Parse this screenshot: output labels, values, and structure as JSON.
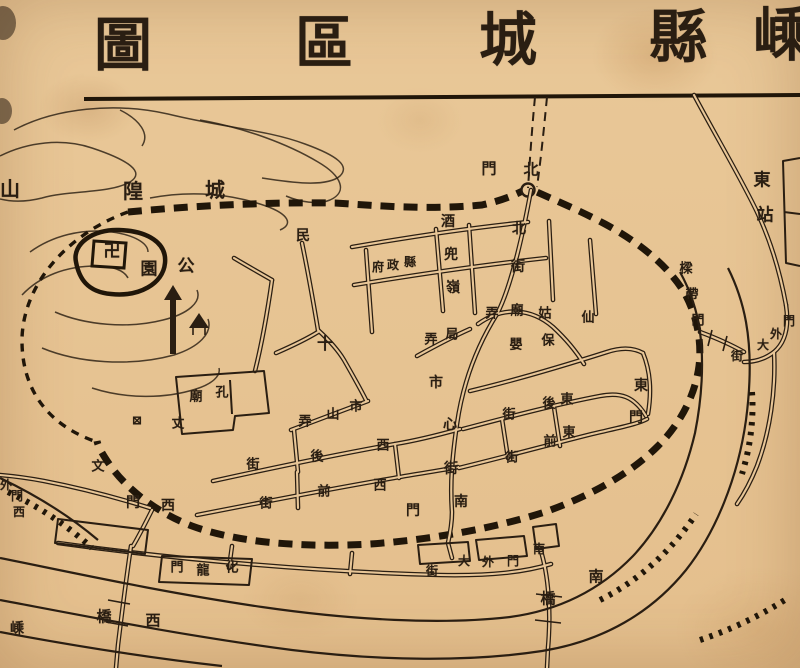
{
  "colors": {
    "paper": "#e8c697",
    "ink": "#2a1e12",
    "wall": "#201609"
  },
  "title": {
    "text": "嵊縣城區圖",
    "reading": "right-to-left",
    "size": 58,
    "chars": [
      {
        "c": "圖",
        "x": 123,
        "y": 45
      },
      {
        "c": "區",
        "x": 324,
        "y": 43
      },
      {
        "c": "城",
        "x": 508,
        "y": 40
      },
      {
        "c": "縣",
        "x": 678,
        "y": 37
      },
      {
        "c": "嵊",
        "x": 782,
        "y": 35
      }
    ]
  },
  "map": {
    "labels": [
      {
        "name": "chenghuang-hill",
        "text": "城隍山",
        "size": 20,
        "chars": [
          {
            "c": "城",
            "x": 215,
            "y": 190
          },
          {
            "c": "隍",
            "x": 133,
            "y": 191
          },
          {
            "c": "山",
            "x": 10,
            "y": 189
          }
        ]
      },
      {
        "name": "park",
        "text": "公園",
        "size": 17,
        "chars": [
          {
            "c": "公",
            "x": 186,
            "y": 267
          },
          {
            "c": "園",
            "x": 149,
            "y": 270
          }
        ]
      },
      {
        "name": "min-label",
        "text": "民",
        "size": 14,
        "chars": [
          {
            "c": "民",
            "x": 303,
            "y": 236
          }
        ]
      },
      {
        "name": "north-gate",
        "text": "北門",
        "size": 15,
        "chars": [
          {
            "c": "北",
            "x": 531,
            "y": 170
          },
          {
            "c": "門",
            "x": 489,
            "y": 169
          }
        ]
      },
      {
        "name": "east-station",
        "text": "東站",
        "size": 17,
        "chars": [
          {
            "c": "東",
            "x": 762,
            "y": 181
          },
          {
            "c": "站",
            "x": 765,
            "y": 216
          }
        ]
      },
      {
        "name": "jiudou-ridge",
        "text": "酒兜嶺",
        "size": 14,
        "chars": [
          {
            "c": "酒",
            "x": 448,
            "y": 222
          },
          {
            "c": "兜",
            "x": 451,
            "y": 255
          },
          {
            "c": "嶺",
            "x": 453,
            "y": 288
          }
        ]
      },
      {
        "name": "north-street",
        "text": "北街",
        "size": 14,
        "chars": [
          {
            "c": "北",
            "x": 519,
            "y": 229
          },
          {
            "c": "街",
            "x": 518,
            "y": 267
          }
        ]
      },
      {
        "name": "county-government",
        "text": "縣政府",
        "size": 12,
        "chars": [
          {
            "c": "府",
            "x": 378,
            "y": 267
          },
          {
            "c": "政",
            "x": 393,
            "y": 265
          },
          {
            "c": "縣",
            "x": 410,
            "y": 262
          }
        ]
      },
      {
        "name": "xiangu-temple-lane",
        "text": "仙姑廟弄",
        "size": 13,
        "chars": [
          {
            "c": "弄",
            "x": 492,
            "y": 314
          },
          {
            "c": "廟",
            "x": 517,
            "y": 311
          },
          {
            "c": "姑",
            "x": 545,
            "y": 314
          },
          {
            "c": "仙",
            "x": 588,
            "y": 318
          }
        ]
      },
      {
        "name": "baoying",
        "text": "保嬰",
        "size": 13,
        "chars": [
          {
            "c": "嬰",
            "x": 516,
            "y": 345
          },
          {
            "c": "保",
            "x": 548,
            "y": 341
          }
        ]
      },
      {
        "name": "ju-lane",
        "text": "局弄",
        "size": 13,
        "chars": [
          {
            "c": "弄",
            "x": 431,
            "y": 340
          },
          {
            "c": "局",
            "x": 452,
            "y": 335
          }
        ]
      },
      {
        "name": "shixin-street",
        "text": "市心街",
        "size": 14,
        "chars": [
          {
            "c": "市",
            "x": 436,
            "y": 383
          },
          {
            "c": "心",
            "x": 450,
            "y": 425
          },
          {
            "c": "街",
            "x": 451,
            "y": 469
          }
        ]
      },
      {
        "name": "east-back-street",
        "text": "東後街",
        "size": 13,
        "chars": [
          {
            "c": "街",
            "x": 509,
            "y": 415
          },
          {
            "c": "後",
            "x": 549,
            "y": 404
          },
          {
            "c": "東",
            "x": 567,
            "y": 400
          }
        ]
      },
      {
        "name": "east-front-street",
        "text": "東前街",
        "size": 13,
        "chars": [
          {
            "c": "街",
            "x": 512,
            "y": 458
          },
          {
            "c": "前",
            "x": 550,
            "y": 442
          },
          {
            "c": "東",
            "x": 569,
            "y": 433
          }
        ]
      },
      {
        "name": "east-gate",
        "text": "東門",
        "size": 14,
        "chars": [
          {
            "c": "東",
            "x": 641,
            "y": 386
          },
          {
            "c": "門",
            "x": 636,
            "y": 418
          }
        ]
      },
      {
        "name": "liangdai-gate",
        "text": "樑帶門",
        "size": 13,
        "chars": [
          {
            "c": "樑",
            "x": 686,
            "y": 269
          },
          {
            "c": "帶",
            "x": 692,
            "y": 295
          },
          {
            "c": "門",
            "x": 698,
            "y": 321
          }
        ]
      },
      {
        "name": "menwai-main-street",
        "text": "門外大街",
        "size": 12,
        "chars": [
          {
            "c": "門",
            "x": 789,
            "y": 321
          },
          {
            "c": "外",
            "x": 776,
            "y": 334
          },
          {
            "c": "大",
            "x": 763,
            "y": 345
          },
          {
            "c": "街",
            "x": 737,
            "y": 356
          }
        ]
      },
      {
        "name": "shishan-lane",
        "text": "市山弄",
        "size": 13,
        "chars": [
          {
            "c": "市",
            "x": 356,
            "y": 407
          },
          {
            "c": "山",
            "x": 333,
            "y": 415
          },
          {
            "c": "弄",
            "x": 305,
            "y": 422
          }
        ]
      },
      {
        "name": "confucius-temple",
        "text": "孔廟",
        "size": 13,
        "chars": [
          {
            "c": "孔",
            "x": 222,
            "y": 393
          },
          {
            "c": "廟",
            "x": 196,
            "y": 397
          }
        ]
      },
      {
        "name": "wen-label",
        "text": "文",
        "size": 13,
        "chars": [
          {
            "c": "文",
            "x": 98,
            "y": 467
          }
        ]
      },
      {
        "name": "zhang-label",
        "text": "丈",
        "size": 13,
        "chars": [
          {
            "c": "丈",
            "x": 178,
            "y": 424
          }
        ]
      },
      {
        "name": "west-back-street",
        "text": "西後街",
        "size": 13,
        "chars": [
          {
            "c": "街",
            "x": 253,
            "y": 465
          },
          {
            "c": "後",
            "x": 317,
            "y": 457
          },
          {
            "c": "西",
            "x": 383,
            "y": 446
          }
        ]
      },
      {
        "name": "west-front-street",
        "text": "西前街",
        "size": 13,
        "chars": [
          {
            "c": "街",
            "x": 266,
            "y": 504
          },
          {
            "c": "前",
            "x": 324,
            "y": 492
          },
          {
            "c": "西",
            "x": 380,
            "y": 486
          }
        ]
      },
      {
        "name": "west-gate",
        "text": "西門",
        "size": 14,
        "chars": [
          {
            "c": "門",
            "x": 133,
            "y": 503
          },
          {
            "c": "西",
            "x": 168,
            "y": 506
          }
        ]
      },
      {
        "name": "west-gate-outer",
        "text": "西門外",
        "size": 12,
        "chars": [
          {
            "c": "外",
            "x": 6,
            "y": 485
          },
          {
            "c": "門",
            "x": 17,
            "y": 496
          },
          {
            "c": "西",
            "x": 19,
            "y": 512
          }
        ]
      },
      {
        "name": "hualong-gate",
        "text": "化龍門",
        "size": 13,
        "chars": [
          {
            "c": "化",
            "x": 232,
            "y": 568
          },
          {
            "c": "龍",
            "x": 203,
            "y": 571
          },
          {
            "c": "門",
            "x": 177,
            "y": 568
          }
        ]
      },
      {
        "name": "west-bridge",
        "text": "西橋",
        "size": 15,
        "chars": [
          {
            "c": "橋",
            "x": 104,
            "y": 617
          },
          {
            "c": "西",
            "x": 153,
            "y": 621
          }
        ]
      },
      {
        "name": "sheng-label",
        "text": "嵊",
        "size": 14,
        "chars": [
          {
            "c": "嵊",
            "x": 17,
            "y": 629
          }
        ]
      },
      {
        "name": "south-gate",
        "text": "南門",
        "size": 14,
        "chars": [
          {
            "c": "門",
            "x": 413,
            "y": 511
          },
          {
            "c": "南",
            "x": 461,
            "y": 502
          }
        ]
      },
      {
        "name": "south-gate-outer-main-street",
        "text": "南門外大街",
        "size": 12,
        "chars": [
          {
            "c": "街",
            "x": 432,
            "y": 571
          },
          {
            "c": "大",
            "x": 464,
            "y": 561
          },
          {
            "c": "外",
            "x": 488,
            "y": 562
          },
          {
            "c": "門",
            "x": 513,
            "y": 561
          },
          {
            "c": "南",
            "x": 539,
            "y": 549
          }
        ]
      },
      {
        "name": "south-bridge",
        "text": "南橋",
        "size": 15,
        "chars": [
          {
            "c": "橋",
            "x": 548,
            "y": 599
          },
          {
            "c": "南",
            "x": 596,
            "y": 577
          }
        ]
      }
    ],
    "symbols": [
      {
        "name": "swastika-temple-symbol",
        "glyph": "卍",
        "x": 112,
        "y": 252,
        "size": 17
      },
      {
        "name": "cross-symbol",
        "glyph": "十",
        "x": 325,
        "y": 344,
        "size": 16
      },
      {
        "name": "school-box-symbol",
        "glyph": "⊠",
        "x": 137,
        "y": 421,
        "size": 13
      }
    ]
  }
}
